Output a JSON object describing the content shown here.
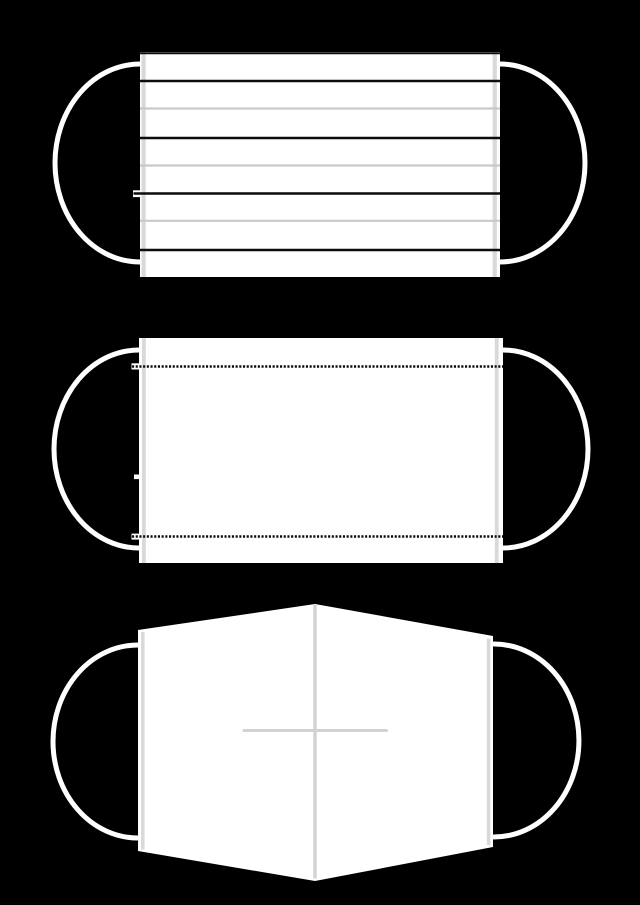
{
  "colors": {
    "background": "#000000",
    "mask_fill": "#ffffff",
    "line_black": "#0c0c0c",
    "line_gray": "#c9c9c9",
    "strip_gray": "#d9d9d9",
    "fold_gray": "#d2d2d2",
    "earloop": "#ffffff"
  },
  "figures": [
    {
      "name": "pleated-surgical-mask-front",
      "black_pleat_lines": 4,
      "gray_pleat_lines": 3
    },
    {
      "name": "plain-mask-back-with-stitch-seams",
      "stitch_seams": 2
    },
    {
      "name": "flat-fold-mask-with-center-crease",
      "crease_lines": 2
    }
  ]
}
